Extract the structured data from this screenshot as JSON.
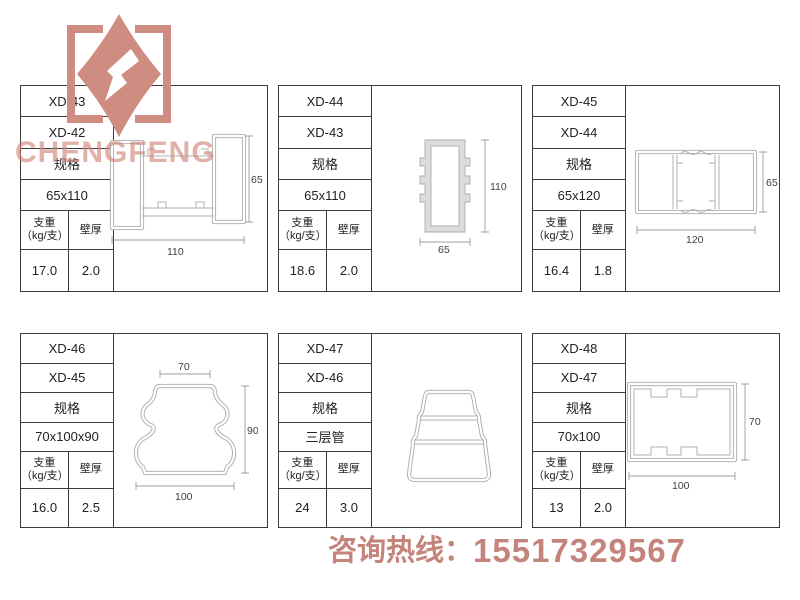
{
  "watermark": "CHENGFENG",
  "logo": {
    "name": "chengfeng-diamond-logo"
  },
  "hotline": {
    "label": "咨询热线：",
    "number": "15517329567"
  },
  "table_headers": {
    "spec": "规格",
    "weight": "支重",
    "weight_unit": "（kg/支）",
    "thickness": "壁厚"
  },
  "products": [
    {
      "model": "XD-43",
      "alt_model": "XD-42",
      "size": "65x110",
      "weight": "17.0",
      "thickness": "2.0",
      "dims": {
        "width": "110",
        "height": "65"
      }
    },
    {
      "model": "XD-44",
      "alt_model": "XD-43",
      "size": "65x110",
      "weight": "18.6",
      "thickness": "2.0",
      "dims": {
        "width": "65",
        "height": "110"
      }
    },
    {
      "model": "XD-45",
      "alt_model": "XD-44",
      "size": "65x120",
      "weight": "16.4",
      "thickness": "1.8",
      "dims": {
        "width": "120",
        "height": "65"
      }
    },
    {
      "model": "XD-46",
      "alt_model": "XD-45",
      "size": "70x100x90",
      "weight": "16.0",
      "thickness": "2.5",
      "dims": {
        "top": "70",
        "width": "100",
        "height": "90"
      }
    },
    {
      "model": "XD-47",
      "alt_model": "XD-46",
      "size": "三层管",
      "weight": "24",
      "thickness": "3.0",
      "dims": {}
    },
    {
      "model": "XD-48",
      "alt_model": "XD-47",
      "size": "70x100",
      "weight": "13",
      "thickness": "2.0",
      "dims": {
        "width": "100",
        "height": "70"
      }
    }
  ],
  "colors": {
    "accent": "#cf8d81",
    "hotline_text": "#c4847b",
    "table_border": "#3c3c3c",
    "drawing_line": "#b2b2b2"
  }
}
